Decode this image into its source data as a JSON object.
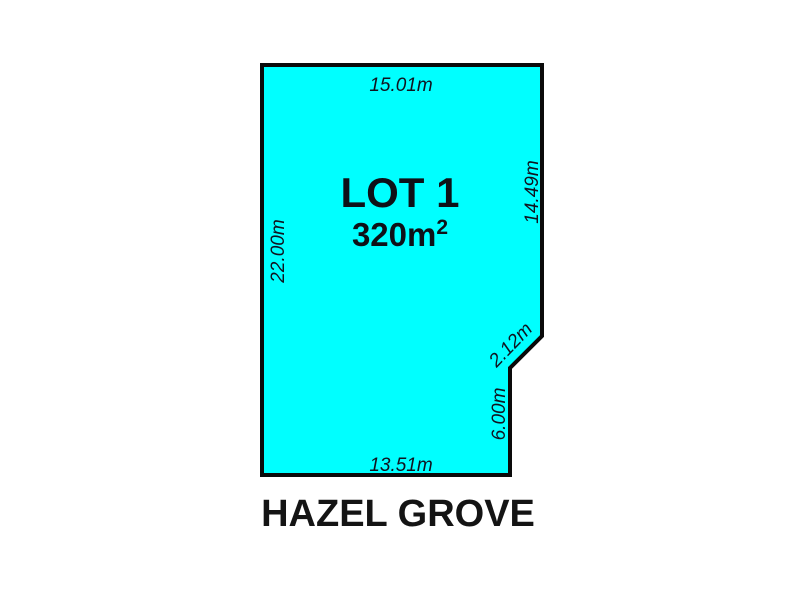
{
  "plan": {
    "lot": {
      "label": "LOT 1",
      "area_value": "320m",
      "area_exponent": "2"
    },
    "street": "HAZEL GROVE",
    "measurements": {
      "top": "15.01m",
      "left": "22.00m",
      "right_upper": "14.49m",
      "splay": "2.12m",
      "right_lower": "6.00m",
      "bottom": "13.51m"
    },
    "colors": {
      "lot_fill": "#00ffff",
      "boundary": "#0a0a0a",
      "text": "#10131f"
    }
  }
}
